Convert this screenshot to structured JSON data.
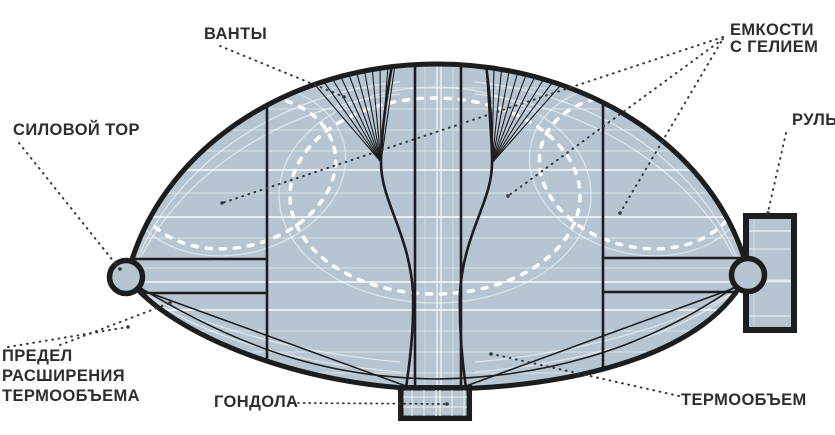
{
  "diagram": {
    "subject": "thermal-airship-cutaway",
    "labels": {
      "vanty": "ВАНТЫ",
      "silovoy_tor": "СИЛОВОЙ ТОР",
      "emkosti_line1": "ЕМКОСТИ",
      "emkosti_line2": "С ГЕЛИЕМ",
      "rul": "РУЛЬ",
      "predel_line1": "ПРЕДЕЛ",
      "predel_line2": "РАСШИРЕНИЯ",
      "predel_line3": "ТЕРМООБЪЕМА",
      "gondola": "ГОНДОЛА",
      "termoobyem": "ТЕРМООБЪЕМ"
    },
    "colors": {
      "background": "#ffffff",
      "envelope_fill": "#b6c5d1",
      "outline": "#1b1d1f",
      "plating_band": "#ffffff",
      "dashed_limit": "#ffffff",
      "leader_dots": "#35383b",
      "label_text": "#2b2e32"
    }
  }
}
